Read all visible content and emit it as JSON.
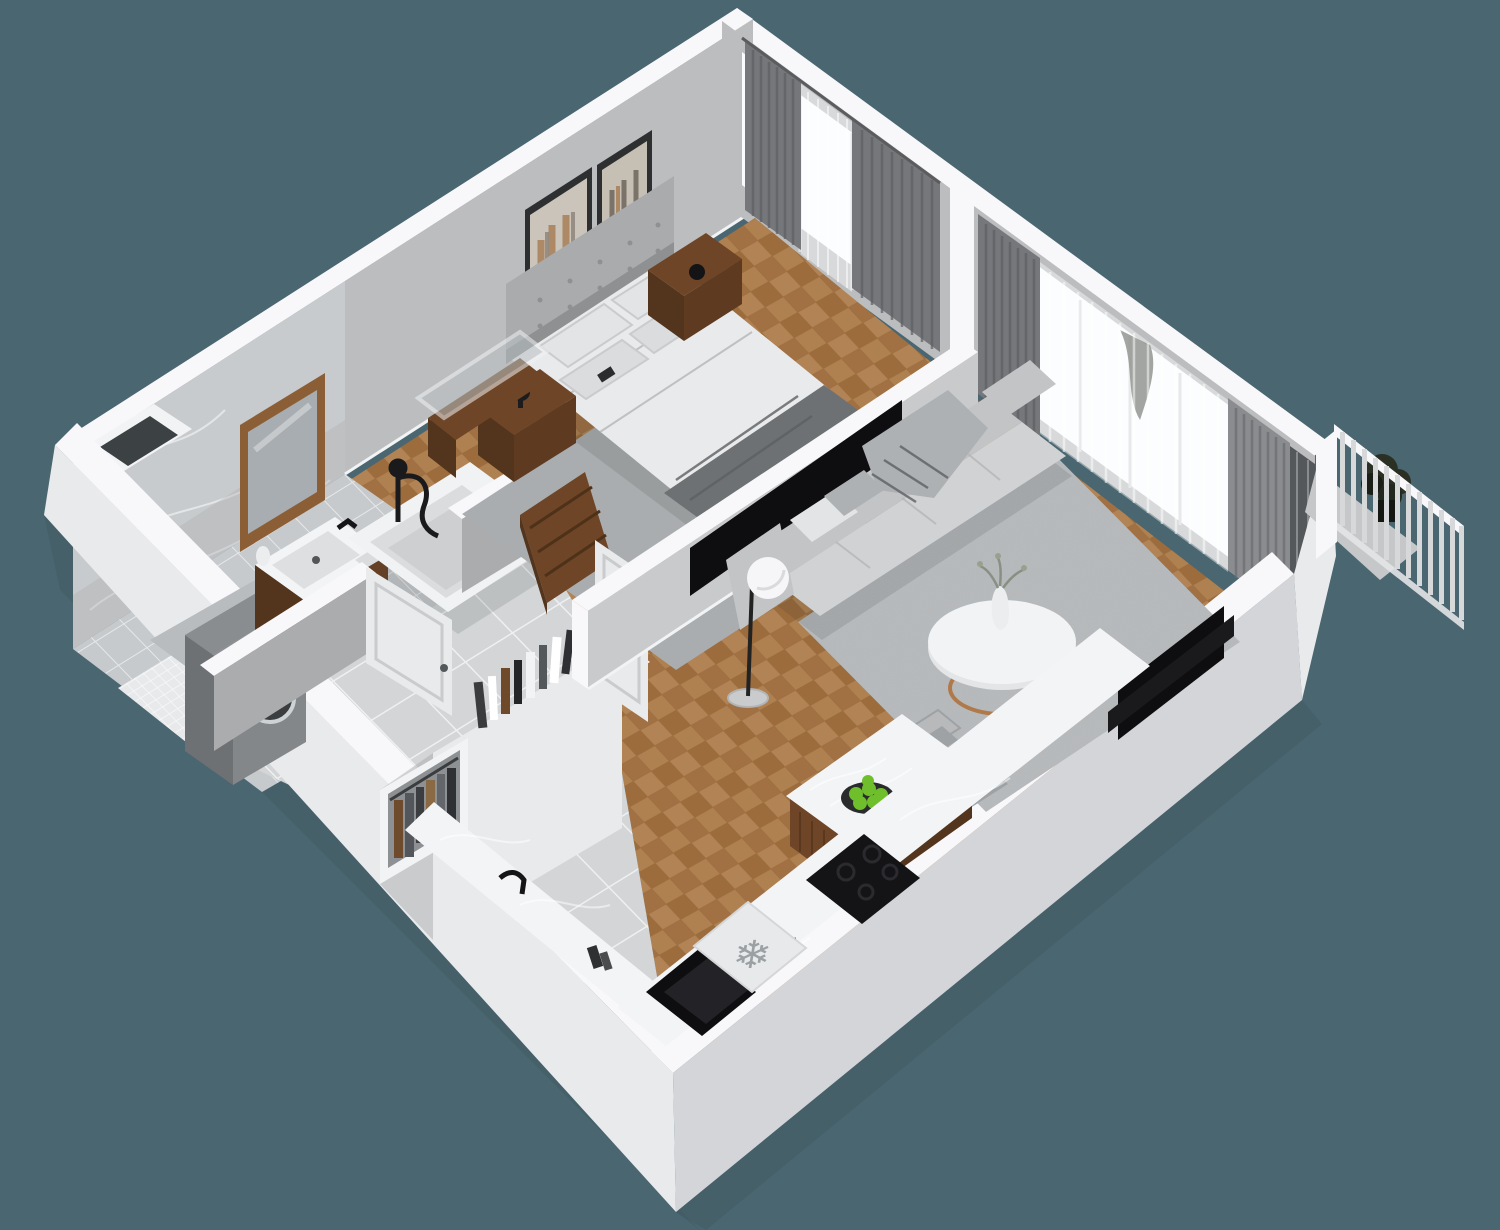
{
  "scene": {
    "type": "isometric-floor-plan-render",
    "description": "3D cutaway floor plan of a one-bedroom apartment viewed from above at an angle",
    "background_color": "#4A6670"
  },
  "palette": {
    "bg": "#4A6670",
    "ground_shadow": "#425B64",
    "ext_light": "#E9EAEC",
    "ext_dark": "#D4D5D8",
    "wall_top": "#F8F8FA",
    "wall_int": "#BCBDBF",
    "wall_int_dark": "#ABACAE",
    "marble": "#C8CBCD",
    "window": "#FAFBFD",
    "curtain": "#75777A",
    "curtain_light": "#8A8C8F",
    "parquet": "#A97B4E",
    "parquet_dark": "#9C6C3C",
    "tile": "#D3D5D7",
    "bath_tile": "#C7CACC",
    "rug": "#B9BCBE",
    "bedroom_rug": "#A9ACAE",
    "sofa": "#D0D2D4",
    "blanket": "#6E7174",
    "wood": "#6E4526",
    "wood_dark": "#53341C",
    "wood_mid": "#5E3A20",
    "black": "#0E0E10",
    "appliance": "#84878A",
    "counter": "#F3F4F6",
    "copper": "#B0794A",
    "apple": "#6FBE2B",
    "snowflake": "#9BA0A3",
    "fence": "#D7D8DA",
    "plant": "#2A3023",
    "door": "#E9EAEC"
  },
  "rooms": [
    {
      "id": "bedroom",
      "contents": [
        "double-bed",
        "headboard",
        "pillows",
        "dark-throw-blanket",
        "nightstand-left",
        "nightstand-right",
        "wall-art-frames",
        "window-curtains",
        "area-rug",
        "wood-console",
        "glass-partition"
      ]
    },
    {
      "id": "living-room",
      "contents": [
        "sofa",
        "throw-blanket",
        "floor-lamp",
        "round-coffee-table",
        "vase",
        "area-rug",
        "tv",
        "curtains",
        "sheer-curtains",
        "balcony-door"
      ]
    },
    {
      "id": "kitchen",
      "contents": [
        "l-shaped-counter",
        "sink",
        "faucet",
        "freezer",
        "cooktop",
        "island",
        "fruit-bowl",
        "bar-chairs"
      ]
    },
    {
      "id": "bathroom",
      "contents": [
        "bathtub",
        "shower-fixture",
        "vanity-sink",
        "mirror",
        "washing-machine",
        "marble-wall",
        "shower-tray"
      ]
    },
    {
      "id": "hallway",
      "contents": [
        "wardrobe",
        "hanging-clothes",
        "books",
        "tile-floor",
        "doors"
      ]
    },
    {
      "id": "balcony",
      "contents": [
        "railing",
        "planter"
      ]
    }
  ],
  "kitchen": {
    "freezer_icon_glyph": "❄"
  }
}
